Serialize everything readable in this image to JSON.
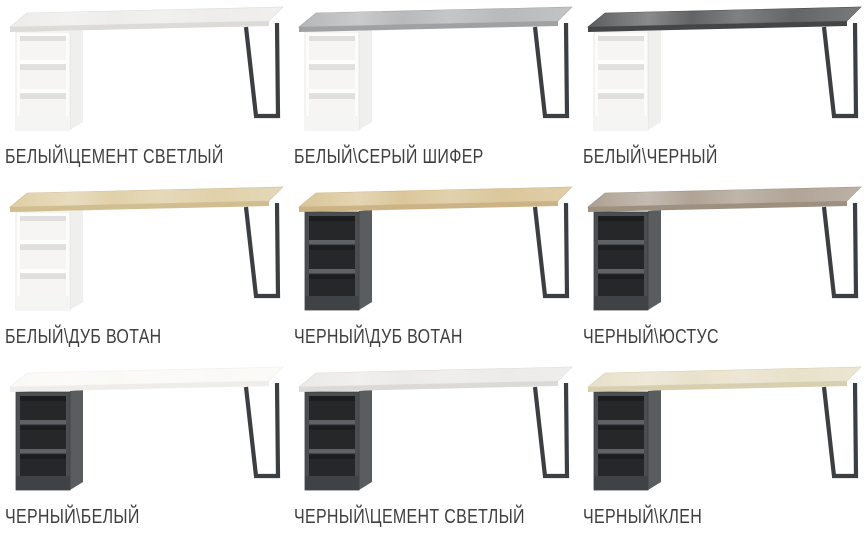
{
  "page": {
    "background_color": "#ffffff",
    "label_text_color": "#3f3f3f"
  },
  "grid": {
    "columns": 3,
    "rows": 3,
    "item_count": 9
  },
  "desks": [
    {
      "label": "БЕЛЫЙ\\ЦЕМЕНТ СВЕТЛЫЙ",
      "colors": {
        "top": "#edecea",
        "top_edge": "#dcdbd8",
        "leg": "#3c3f42",
        "cabinet": {
          "frame": "#fcfcfb",
          "side": "#efefee",
          "interior": "#f6f5f3",
          "comp_shadow": "#e0dfdd",
          "shelf": "#fdfdfc",
          "shelf_edge": "#e3e3e1",
          "plinth": "#f5f5f4",
          "outline": "#e4e4e2"
        }
      }
    },
    {
      "label": "БЕЛЫЙ\\СЕРЫЙ ШИФЕР",
      "colors": {
        "top": "#b4b6b8",
        "top_edge": "#9fa1a3",
        "leg": "#3c3f42",
        "cabinet": {
          "frame": "#fcfcfb",
          "side": "#efefee",
          "interior": "#f6f5f3",
          "comp_shadow": "#e0dfdd",
          "shelf": "#fdfdfc",
          "shelf_edge": "#e3e3e1",
          "plinth": "#f5f5f4",
          "outline": "#e4e4e2"
        }
      }
    },
    {
      "label": "БЕЛЫЙ\\ЧЕРНЫЙ",
      "colors": {
        "top": "#5b5d5f",
        "top_edge": "#434547",
        "leg": "#3c3f42",
        "cabinet": {
          "frame": "#fcfcfb",
          "side": "#efefee",
          "interior": "#f6f5f3",
          "comp_shadow": "#e0dfdd",
          "shelf": "#fdfdfc",
          "shelf_edge": "#e3e3e1",
          "plinth": "#f5f5f4",
          "outline": "#e4e4e2"
        }
      }
    },
    {
      "label": "БЕЛЫЙ\\ДУБ ВОТАН",
      "colors": {
        "top": "#dfcfa6",
        "top_edge": "#d0bd90",
        "leg": "#3c3f42",
        "cabinet": {
          "frame": "#fcfcfb",
          "side": "#efefee",
          "interior": "#f6f5f3",
          "comp_shadow": "#e0dfdd",
          "shelf": "#fdfdfc",
          "shelf_edge": "#e3e3e1",
          "plinth": "#f5f5f4",
          "outline": "#e4e4e2"
        }
      }
    },
    {
      "label": "ЧЕРНЫЙ\\ДУБ ВОТАН",
      "colors": {
        "top": "#d9c496",
        "top_edge": "#ccb385",
        "leg": "#3c3f42",
        "cabinet": {
          "frame": "#4b4e51",
          "side": "#5a5d60",
          "interior": "#252729",
          "comp_shadow": "#1b1d1f",
          "shelf": "#5f6265",
          "shelf_edge": "#43464a",
          "plinth": "#404346",
          "outline": "#3c3f42"
        }
      }
    },
    {
      "label": "ЧЕРНЫЙ\\ЮСТУС",
      "colors": {
        "top": "#ada092",
        "top_edge": "#9e9080",
        "leg": "#3c3f42",
        "cabinet": {
          "frame": "#4b4e51",
          "side": "#5a5d60",
          "interior": "#252729",
          "comp_shadow": "#1b1d1f",
          "shelf": "#5f6265",
          "shelf_edge": "#43464a",
          "plinth": "#404346",
          "outline": "#3c3f42"
        }
      }
    },
    {
      "label": "ЧЕРНЫЙ\\БЕЛЫЙ",
      "colors": {
        "top": "#faf9f6",
        "top_edge": "#eeede9",
        "leg": "#3c3f42",
        "cabinet": {
          "frame": "#4b4e51",
          "side": "#5a5d60",
          "interior": "#252729",
          "comp_shadow": "#1b1d1f",
          "shelf": "#5f6265",
          "shelf_edge": "#43464a",
          "plinth": "#404346",
          "outline": "#3c3f42"
        }
      }
    },
    {
      "label": "ЧЕРНЫЙ\\ЦЕМЕНТ СВЕТЛЫЙ",
      "colors": {
        "top": "#ebeae8",
        "top_edge": "#dbdad7",
        "leg": "#3c3f42",
        "cabinet": {
          "frame": "#4b4e51",
          "side": "#5a5d60",
          "interior": "#252729",
          "comp_shadow": "#1b1d1f",
          "shelf": "#5f6265",
          "shelf_edge": "#43464a",
          "plinth": "#404346",
          "outline": "#3c3f42"
        }
      }
    },
    {
      "label": "ЧЕРНЫЙ\\КЛЕН",
      "colors": {
        "top": "#e7e0c9",
        "top_edge": "#d8cfb0",
        "leg": "#3c3f42",
        "cabinet": {
          "frame": "#4b4e51",
          "side": "#5a5d60",
          "interior": "#252729",
          "comp_shadow": "#1b1d1f",
          "shelf": "#5f6265",
          "shelf_edge": "#43464a",
          "plinth": "#404346",
          "outline": "#3c3f42"
        }
      }
    }
  ]
}
